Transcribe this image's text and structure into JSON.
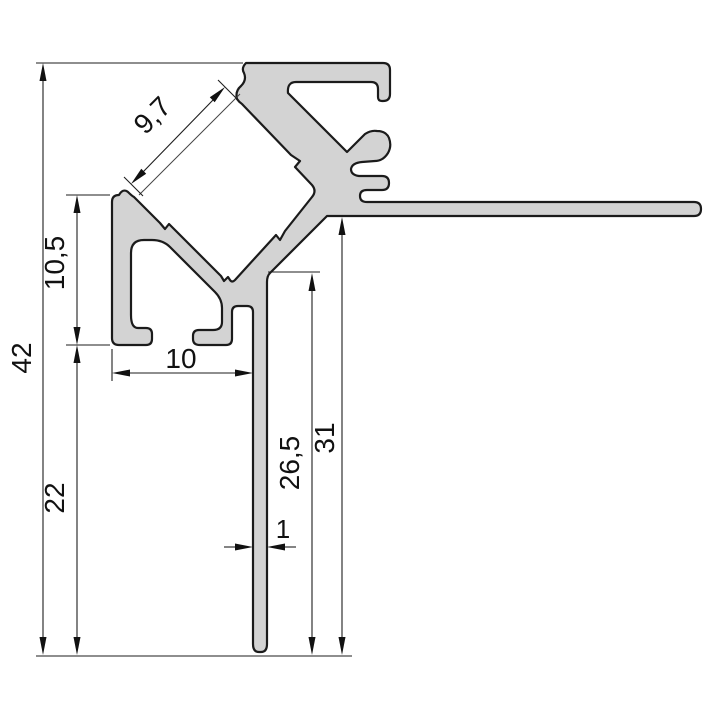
{
  "drawing": {
    "kind": "profile-cross-section-technical-drawing",
    "decimal_style": "comma",
    "colors": {
      "background": "#ffffff",
      "profile_fill": "#d3d3d3",
      "profile_outline": "#1b1b1b",
      "dimension_line": "#1e1e1e",
      "text": "#111111"
    },
    "dimensions": {
      "overall_height": "42",
      "foot_height": "10,5",
      "lower_height": "22",
      "foot_width": "10",
      "channel_opening": "9,7",
      "leg_thickness": "1",
      "leg_drop": "26,5",
      "flange_drop": "31"
    }
  }
}
